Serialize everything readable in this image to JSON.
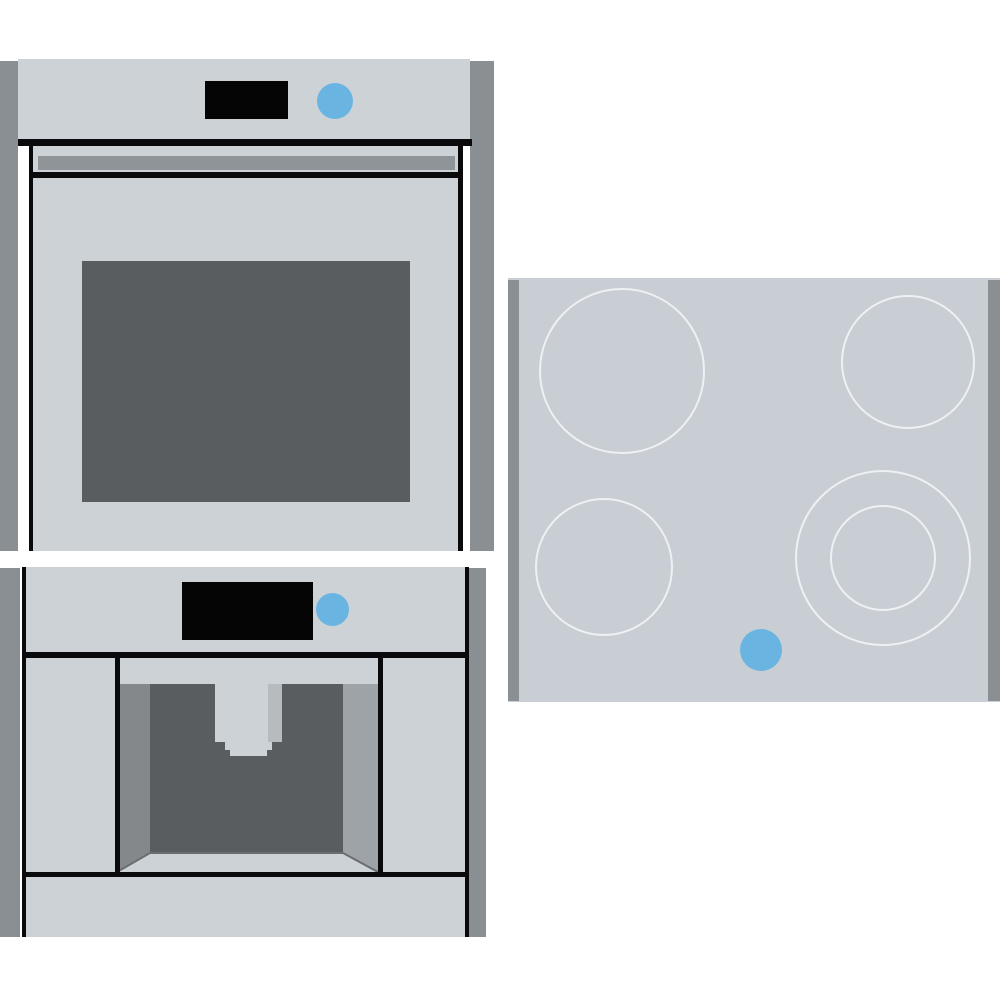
{
  "scene": {
    "title": "Built-in kitchen appliance set illustration",
    "appliances": [
      {
        "id": "wall-oven",
        "label": "Built-in single oven",
        "parts": [
          "cabinet side panels",
          "control panel",
          "black display",
          "blue power knob",
          "door handle",
          "door with dark window"
        ]
      },
      {
        "id": "coffee-machine",
        "label": "Built-in coffee machine",
        "parts": [
          "cabinet side panels",
          "control panel",
          "black display",
          "blue power knob",
          "cup recess with dispensing spout",
          "bottom drawer panel"
        ]
      },
      {
        "id": "cooktop",
        "label": "Ceramic glass cooktop",
        "burners": [
          {
            "position": "back-left",
            "size": "large",
            "rings": 1
          },
          {
            "position": "back-right",
            "size": "medium",
            "rings": 1
          },
          {
            "position": "front-left",
            "size": "medium",
            "rings": 1
          },
          {
            "position": "front-right",
            "size": "large",
            "rings": 2
          }
        ],
        "parts": [
          "side trim strips",
          "four burner outlines",
          "blue power dot"
        ]
      }
    ]
  },
  "colors": {
    "pageBg": "#ffffff",
    "body": "#cdd2d7",
    "cooktopSurface": "#c9ced4",
    "sideStrip": "#8a8f94",
    "black": "#0a0a0c",
    "display": "#050506",
    "knobBlue": "#6ab4e2",
    "handle": "#8f9499",
    "windowGlass": "#595d60",
    "recessLeftWall": "#85888b",
    "recessBack": "#5a5d5f",
    "recessRightWall": "#9ea3a8",
    "recessFloor": "#cdd2d6",
    "recessEdge": "#6b6e71",
    "spoutShade": "#b6bbc0",
    "burnerStroke": "#eef1f3"
  }
}
